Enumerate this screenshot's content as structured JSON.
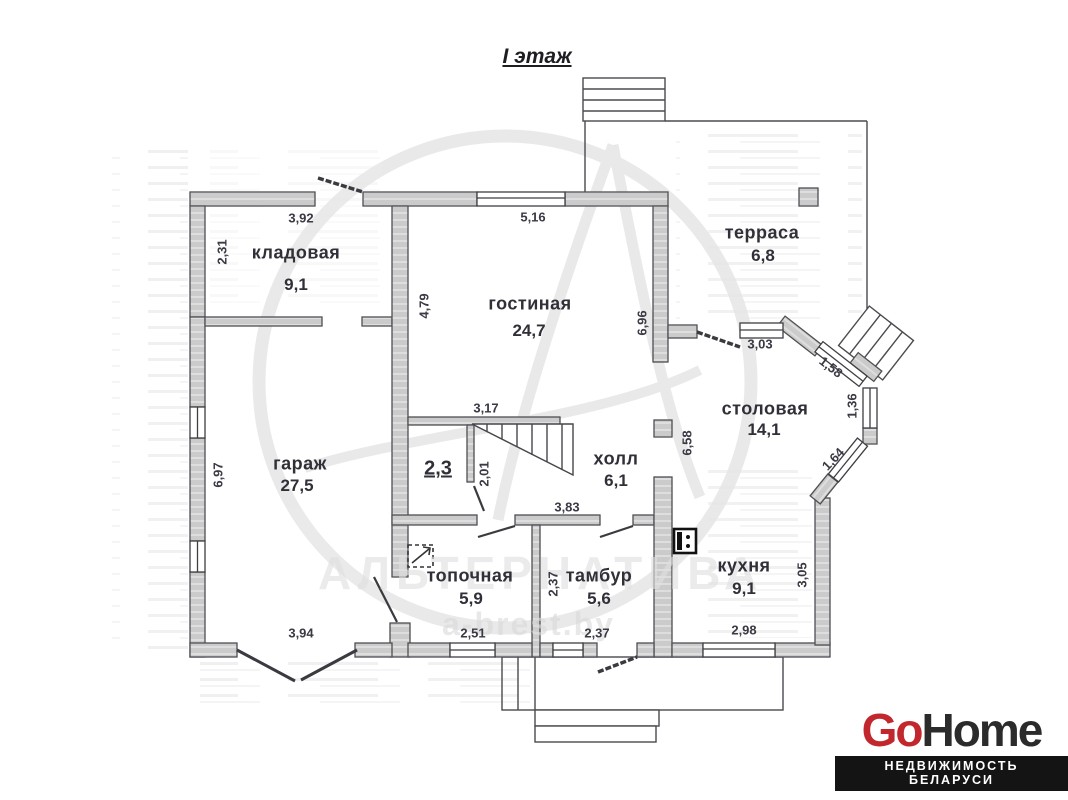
{
  "title": "I этаж",
  "watermark": {
    "name": "АЛЬТЕРНАТИВА",
    "site": "a-brest.by"
  },
  "logo": {
    "go": "Go",
    "home": "Home",
    "tagline": "НЕДВИЖИМОСТЬ БЕЛАРУСИ",
    "accent_color": "#c1272d",
    "dark_color": "#2b2b2b"
  },
  "rooms": {
    "storage": {
      "name": "кладовая",
      "area": "9,1"
    },
    "living": {
      "name": "гостиная",
      "area": "24,7"
    },
    "terrace": {
      "name": "терраса",
      "area": "6,8"
    },
    "garage": {
      "name": "гараж",
      "area": "27,5"
    },
    "dining": {
      "name": "столовая",
      "area": "14,1"
    },
    "hall": {
      "name": "холл",
      "area": "6,1"
    },
    "boiler": {
      "name": "топочная",
      "area": "5,9"
    },
    "vestibule": {
      "name": "тамбур",
      "area": "5,6"
    },
    "kitchen": {
      "name": "кухня",
      "area": "9,1"
    },
    "wc": {
      "area": "2,3"
    }
  },
  "dimensions": {
    "storage_top": "3,92",
    "storage_left": "2,31",
    "living_top": "5,16",
    "living_left": "4,79",
    "terrace_side": "6,96",
    "dining_top": "3,03",
    "bay_upper": "1,58",
    "bay_mid": "1,36",
    "bay_lower": "1,64",
    "dining_left": "6,58",
    "stairs_top": "3,17",
    "stairs_left": "2,01",
    "hall_bottom": "3,83",
    "garage_left": "6,97",
    "garage_bottom": "3,94",
    "boiler_bottom": "2,51",
    "vestibule_left": "2,37",
    "vestibule_bottom": "2,37",
    "kitchen_bottom": "2,98",
    "kitchen_right": "3,05"
  }
}
